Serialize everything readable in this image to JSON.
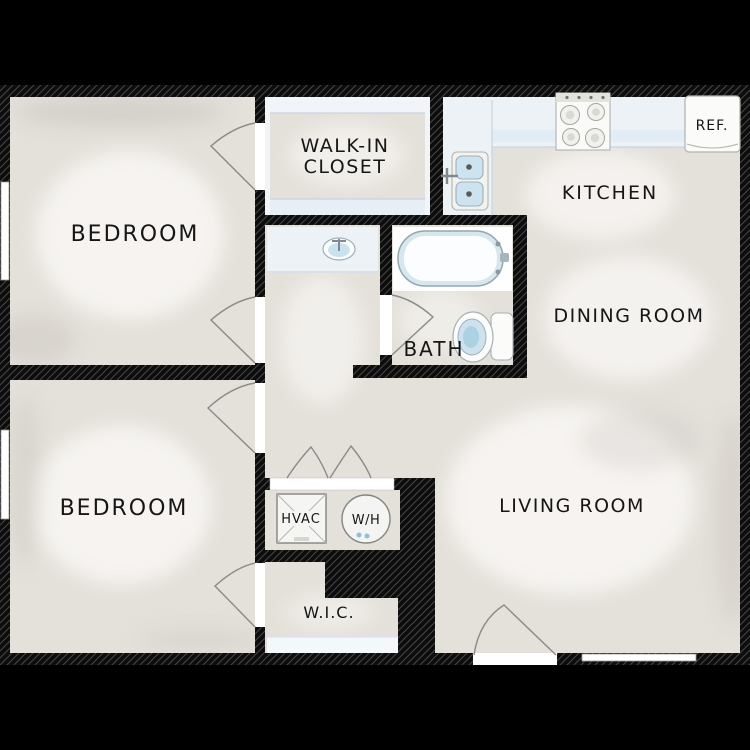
{
  "title": "Two Bedroom Apartment Floor Plan",
  "rooms": {
    "bedroom_top": {
      "label": "BEDROOM"
    },
    "bedroom_bottom": {
      "label": "BEDROOM"
    },
    "walk_in_closet": {
      "label_line1": "WALK-IN",
      "label_line2": "CLOSET"
    },
    "kitchen": {
      "label": "KITCHEN"
    },
    "dining_room": {
      "label": "DINING ROOM"
    },
    "living_room": {
      "label": "LIVING ROOM"
    },
    "bath": {
      "label": "BATH"
    },
    "wic": {
      "label": "W.I.C."
    }
  },
  "fixtures": {
    "hvac": {
      "label": "HVAC"
    },
    "water_heater": {
      "label": "W/H"
    },
    "refrigerator": {
      "label": "REF."
    },
    "items": [
      "bathtub",
      "toilet",
      "vanity-sink",
      "kitchen-double-sink",
      "stove",
      "refrigerator",
      "hvac-unit",
      "water-heater",
      "bifold-doors",
      "closet-shelving",
      "wic-shelf"
    ]
  },
  "colors": {
    "background": "#000000",
    "wall": "#0d0d0d",
    "wall_hatch": "#454545",
    "floor": "#e4e0da",
    "floor_highlight": "#f7f5f2",
    "floor_shade": "#c9c5bf",
    "counter": "#edf2f7",
    "fixture_blue": "#cde3ef",
    "fixture_outline": "#9db0ba",
    "door_arc": "#8a8a8a",
    "label_text": "#161616"
  }
}
